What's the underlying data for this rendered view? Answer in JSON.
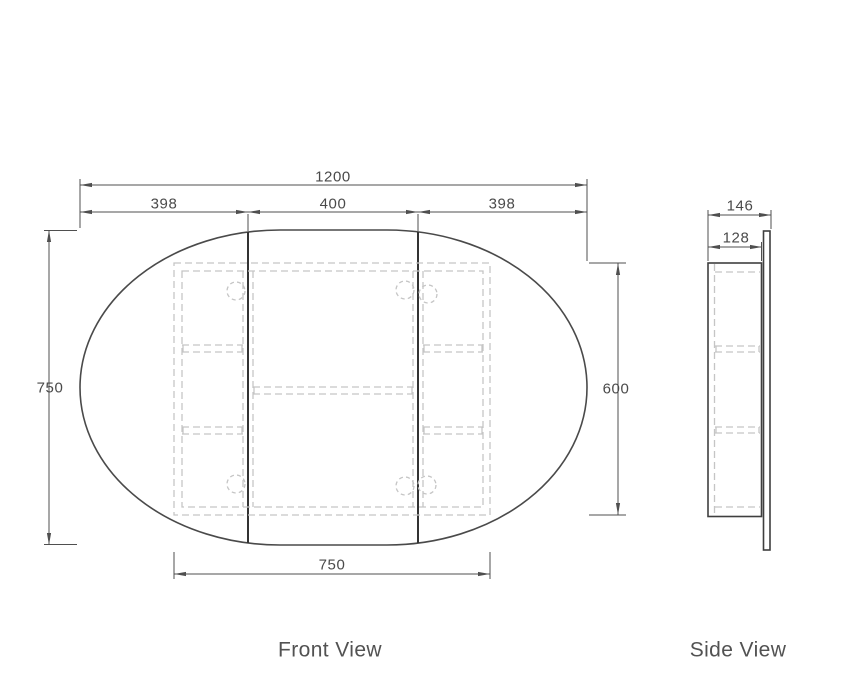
{
  "front_view": {
    "label": "Front View",
    "dims": {
      "overall_width": "1200",
      "door_left_width": "398",
      "door_center_width": "400",
      "door_right_width": "398",
      "mirror_height": "750",
      "cabinet_height": "600",
      "cabinet_width": "750"
    }
  },
  "side_view": {
    "label": "Side View",
    "dims": {
      "overall_depth": "146",
      "cabinet_depth": "128"
    }
  },
  "colors": {
    "solid_line": "#3d3d3d",
    "divider_line": "#333333",
    "dimension_line": "#4f4f4f",
    "hidden_line": "#c5c5c5",
    "text": "#4a4a4a"
  }
}
